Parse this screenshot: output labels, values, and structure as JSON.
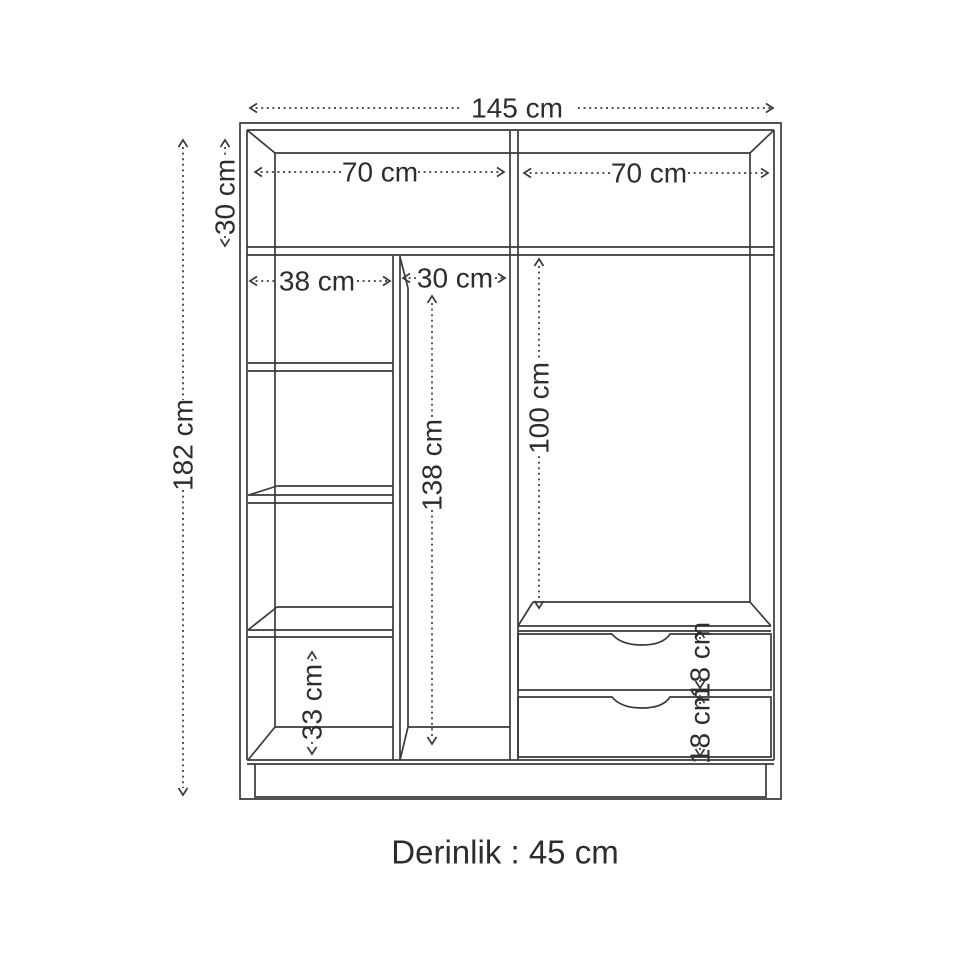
{
  "page": {
    "background": "#ffffff"
  },
  "diagram": {
    "type": "furniture-dimension-drawing",
    "subject": "wardrobe front elevation with dimensions",
    "line_color": "#3a3a3a",
    "text_color": "#2d2d2d",
    "caption": "Derinlik : 45 cm",
    "labels": {
      "total_width": "145 cm",
      "total_height": "182 cm",
      "top_section_height": "30 cm",
      "top_left_compartment_width": "70 cm",
      "top_right_compartment_width": "70 cm",
      "left_column_width": "38 cm",
      "middle_column_width": "30 cm",
      "middle_column_height": "138 cm",
      "hanging_section_height": "100 cm",
      "bottom_left_compartment_height": "33 cm",
      "upper_drawer_height": "18 cm",
      "lower_drawer_height": "18 cm"
    }
  }
}
